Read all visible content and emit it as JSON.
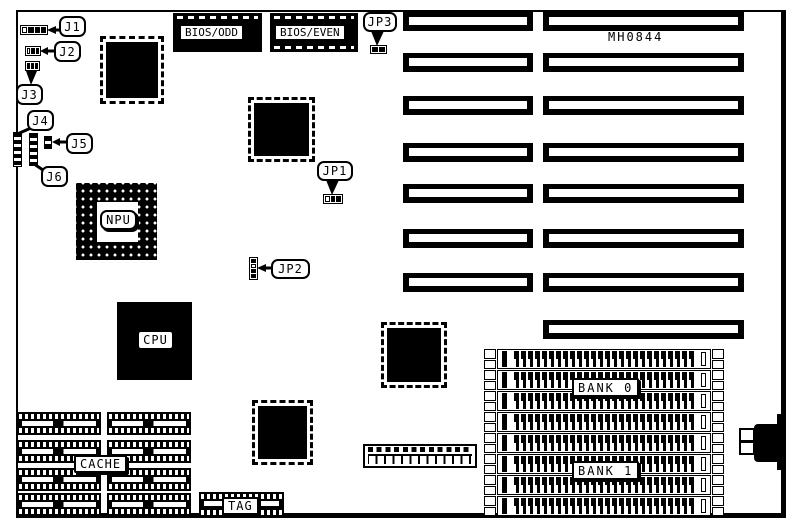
{
  "diagram": {
    "board_id": "MH0844",
    "jumpers": {
      "j1": "J1",
      "j2": "J2",
      "j3": "J3",
      "j4": "J4",
      "j5": "J5",
      "j6": "J6",
      "jp1": "JP1",
      "jp2": "JP2",
      "jp3": "JP3"
    },
    "chips": {
      "bios_odd": "BIOS/ODD",
      "bios_even": "BIOS/EVEN",
      "npu": "NPU",
      "cpu": "CPU"
    },
    "memory": {
      "bank0": "BANK 0",
      "bank1": "BANK 1",
      "cache": "CACHE",
      "tag": "TAG"
    },
    "colors": {
      "ink": "#000000",
      "paper": "#ffffff"
    }
  }
}
